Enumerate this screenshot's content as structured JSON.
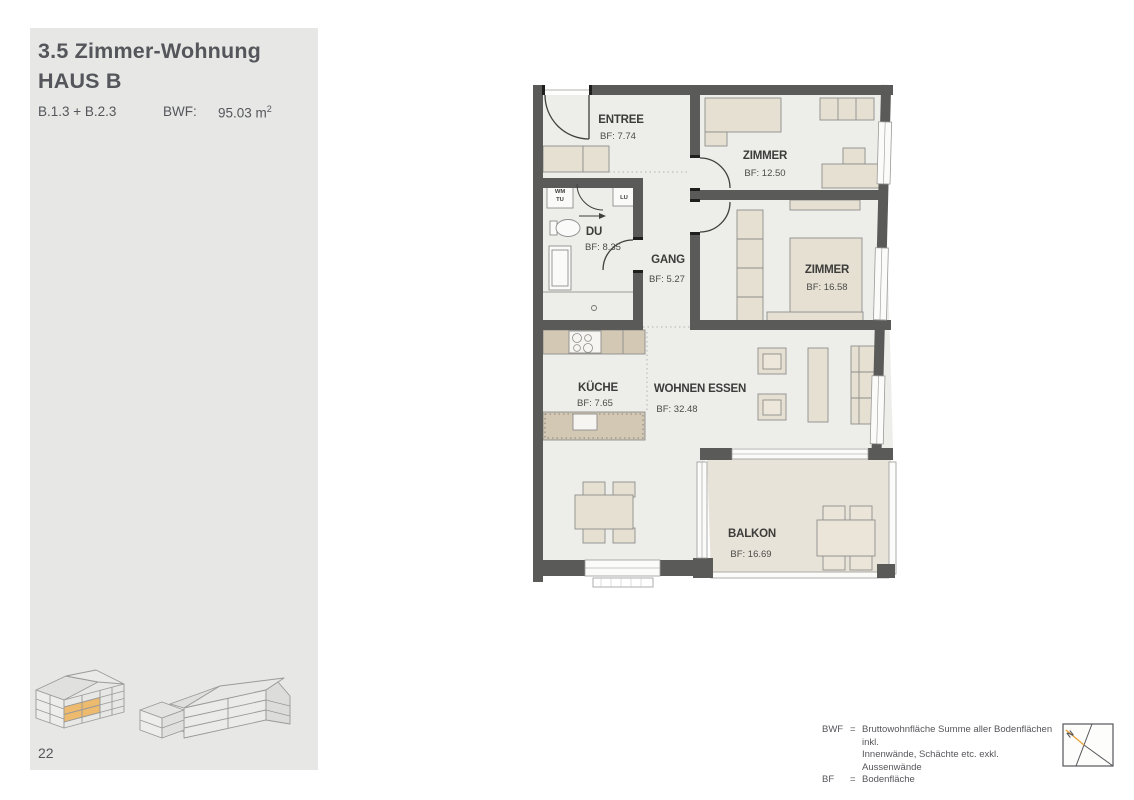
{
  "sidebar": {
    "title_line1": "3.5 Zimmer-Wohnung",
    "title_line2": "HAUS B",
    "unit_ids": "B.1.3 + B.2.3",
    "bwf_label": "BWF:",
    "bwf_value": "95.03 m",
    "bwf_value_sup": "2",
    "page_number": "22"
  },
  "plan": {
    "rooms": [
      {
        "name": "ENTREE",
        "bf": "BF: 7.74"
      },
      {
        "name": "ZIMMER",
        "bf": "BF: 12.50"
      },
      {
        "name": "ZIMMER",
        "bf": "BF: 16.58"
      },
      {
        "name": "DU",
        "bf": "BF: 8.35"
      },
      {
        "name": "GANG",
        "bf": "BF: 5.27"
      },
      {
        "name": "KÜCHE",
        "bf": "BF: 7.65"
      },
      {
        "name": "WOHNEN ESSEN",
        "bf": "BF: 32.48"
      },
      {
        "name": "BALKON",
        "bf": "BF: 16.69"
      }
    ],
    "fixtures": {
      "wm": "WM",
      "tu": "TU",
      "lu": "LU"
    }
  },
  "legend": {
    "row1_term": "BWF",
    "row1_eq": "=",
    "row1_text": "Bruttowohnfläche Summe aller Bodenflächen inkl.",
    "row2_text": "Innenwände, Schächte etc. exkl. Aussenwände",
    "row3_term": "BF",
    "row3_eq": "=",
    "row3_text": "Bodenfläche"
  },
  "north_arrow": {
    "label": "N"
  },
  "colors": {
    "wall": "#5a5a58",
    "floor": "#edeeea",
    "balcony_floor": "#e8e3d9",
    "furniture": "#e6e0d2",
    "counter": "#d3c8b4",
    "highlight_orange": "#edba6e",
    "sidebar_bg": "#e7e7e5",
    "text": "#54565b"
  }
}
